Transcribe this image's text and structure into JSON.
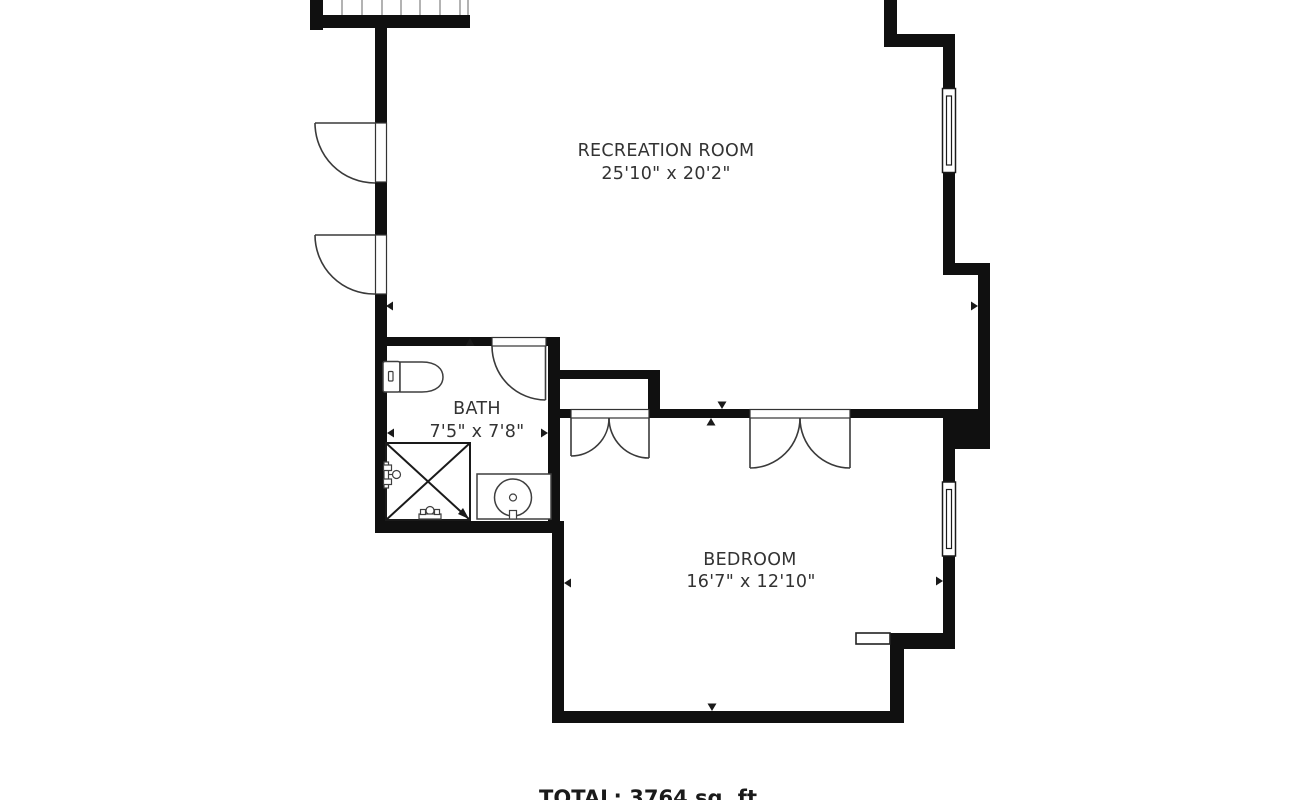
{
  "canvas": {
    "width": 1300,
    "height": 800
  },
  "colors": {
    "background": "#ffffff",
    "wall": "#101010",
    "door_line": "#3a3a3a",
    "fixture_line": "#3f3f3f",
    "text": "#333333"
  },
  "rooms": {
    "recreation": {
      "name": "RECREATION ROOM",
      "dimensions": "25'10\" x 20'2\""
    },
    "bath": {
      "name": "BATH",
      "dimensions": "7'5\" x 7'8\""
    },
    "bedroom": {
      "name": "BEDROOM",
      "dimensions": "16'7\" x 12'10\""
    }
  },
  "footer": {
    "total_label": "TOTAL: 3764 sq. ft"
  }
}
